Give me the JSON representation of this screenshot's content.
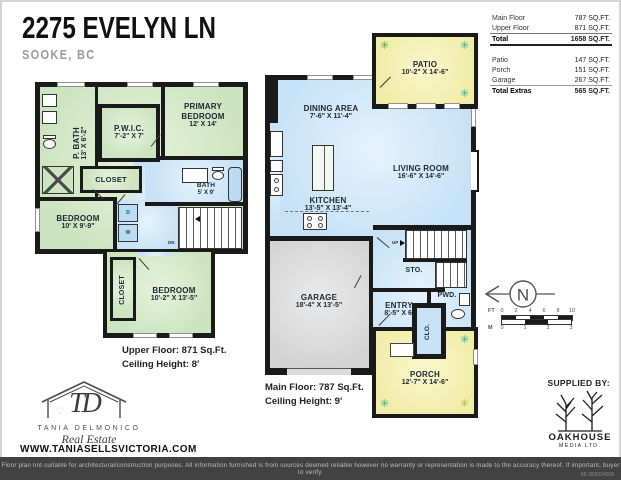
{
  "header": {
    "title": "2275 EVELYN LN",
    "subtitle": "SOOKE, BC"
  },
  "area_table": {
    "rows": [
      {
        "label": "Main Floor",
        "value": "787 SQ.FT."
      },
      {
        "label": "Upper Floor",
        "value": "871 SQ.FT."
      },
      {
        "label": "Total",
        "value": "1658 SQ.FT."
      },
      {
        "label": "Patio",
        "value": "147 SQ.FT."
      },
      {
        "label": "Porch",
        "value": "151 SQ.FT."
      },
      {
        "label": "Garage",
        "value": "267 SQ.FT."
      },
      {
        "label": "Total Extras",
        "value": "565 SQ.FT."
      }
    ]
  },
  "upper_floor": {
    "caption": {
      "line1": "Upper Floor: 871 Sq.Ft.",
      "line2": "Ceiling Height: 8'"
    },
    "rooms": {
      "primary_bath": {
        "name": "P. BATH",
        "dims": "13' X 6'-2\""
      },
      "pwic": {
        "name": "P.W.I.C.",
        "dims": "7'-2\" X 7'"
      },
      "primary_bedroom": {
        "name": "PRIMARY BEDROOM",
        "dims": "12' X 14'"
      },
      "closet_hall": {
        "name": "CLOSET"
      },
      "bedroom_left": {
        "name": "BEDROOM",
        "dims": "10' X 9'-9\""
      },
      "bath": {
        "name": "BATH",
        "dims": "5' X 9'"
      },
      "closet_lower": {
        "name": "CLOSET"
      },
      "bedroom_lower": {
        "name": "BEDROOM",
        "dims": "10'-2\" X 13'-5\""
      }
    },
    "labels": {
      "dn": "DN",
      "dryer": "D",
      "washer": "W"
    }
  },
  "main_floor": {
    "caption": {
      "line1": "Main Floor: 787 Sq.Ft.",
      "line2": "Ceiling Height: 9'"
    },
    "rooms": {
      "patio": {
        "name": "PATIO",
        "dims": "10'-2\" X 14'-6\""
      },
      "dining": {
        "name": "DINING AREA",
        "dims": "7'-6\" X 11'-4\""
      },
      "living": {
        "name": "LIVING ROOM",
        "dims": "16'-6\" X 14'-6\""
      },
      "kitchen": {
        "name": "KITCHEN",
        "dims": "13'-5\" X 13'-4\""
      },
      "garage": {
        "name": "GARAGE",
        "dims": "18'-4\" X 13'-5\""
      },
      "entry": {
        "name": "ENTRY",
        "dims": "8'-5\" X 6'"
      },
      "storage": {
        "name": "STO."
      },
      "powder": {
        "name": "PWD."
      },
      "closet": {
        "name": "CLO."
      },
      "porch": {
        "name": "PORCH",
        "dims": "12'-7\" X 14'-6\""
      }
    },
    "labels": {
      "up": "UP"
    }
  },
  "compass": {
    "north": "N"
  },
  "scale_bar": {
    "ft_label": "FT",
    "ft_ticks": [
      "0",
      "2",
      "4",
      "6",
      "8",
      "10"
    ],
    "m_label": "M",
    "m_ticks": [
      "0",
      "1",
      "2",
      "3"
    ]
  },
  "agent": {
    "monogram": "TD",
    "name": "TANIA DELMONICO",
    "tagline": "Real Estate",
    "website": "WWW.TANIASELLSVICTORIA.COM"
  },
  "supplier": {
    "heading": "SUPPLIED BY:",
    "name": "OAKHOUSE",
    "subname": "MEDIA LTD."
  },
  "footer": {
    "disclaimer": "Floor plan not suitable for architectural/construction purposes. All information furnished is from sources deemed reliable however no warranty or representation is made to the accuracy thereof. If important, buyer to verify.",
    "reference": "MLSB9324508"
  },
  "colors": {
    "room_green": "#cde4c0",
    "room_blue": "#c7e2f6",
    "outdoor_yellow": "#f1eda8",
    "garage_gray": "#d4d4d4",
    "wall": "#1a1a1a",
    "plant_teal": "#1fb3a0",
    "plant_green": "#3fae49"
  }
}
